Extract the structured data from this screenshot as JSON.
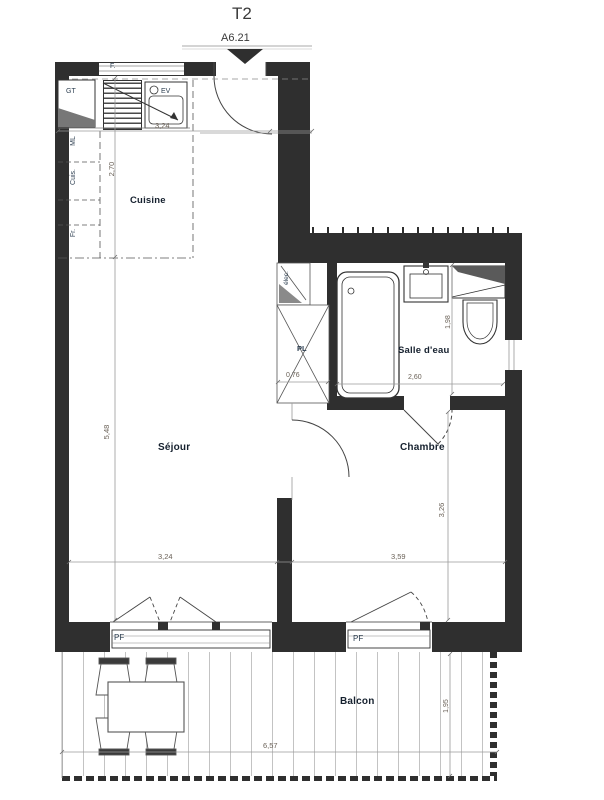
{
  "plan": {
    "title": "T2",
    "unit_ref": "A6.21",
    "rooms": {
      "cuisine": "Cuisine",
      "sejour": "Séjour",
      "chambre": "Chambre",
      "salle_eau": "Salle d'eau",
      "balcon": "Balcon"
    },
    "annotations": {
      "window_f": "F.",
      "gt": "GT",
      "ev": "EV",
      "ml": "ML",
      "cuis": "Cuis.",
      "fr": "Fr.",
      "elec": "élec.",
      "placard": "PL",
      "pf_left": "PF",
      "pf_right": "PF"
    },
    "dimensions": {
      "cuisine_width": "3,24",
      "cuisine_depth": "2,70",
      "sejour_height": "5,48",
      "sejour_width": "3,24",
      "chambre_width": "3,59",
      "chambre_height": "3,26",
      "salle_eau_width": "2,60",
      "salle_eau_height": "1,98",
      "placard_width": "0,76",
      "balcon_width": "6,57",
      "balcon_depth": "1,95"
    },
    "colors": {
      "wall": "#2f2f2f",
      "dim_text": "#6b6258",
      "room_text": "#15202e"
    }
  }
}
